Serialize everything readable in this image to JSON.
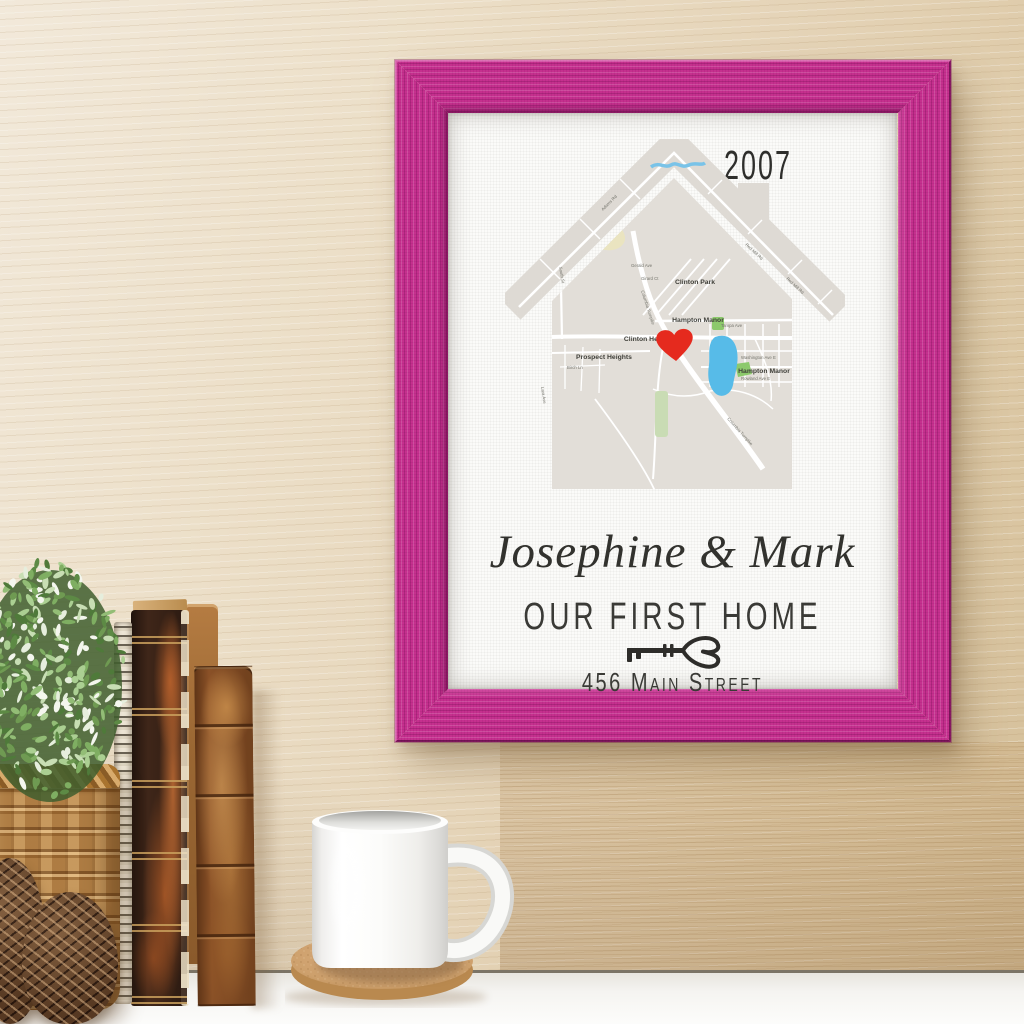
{
  "artwork": {
    "year": "2007",
    "names": "Josephine & Mark",
    "subtitle": "OUR FIRST HOME",
    "address": "456 Main Street",
    "map": {
      "district_labels": [
        "Clinton Park",
        "Hampton Manor",
        "Clinton Heights",
        "Prospect Heights",
        "Hampton Manor"
      ],
      "street_labels": [
        "Columbia Turnpike",
        "Columbia Turnpike",
        "Red Mill Rd",
        "Red Mill Rd",
        "Tampa Ave",
        "Washington Ave E",
        "Rowland Ave E",
        "South St",
        "Gerald Ave",
        "Girard Ct",
        "Adams Rd",
        "Birch Ln",
        "Lara Ave"
      ]
    }
  },
  "colors": {
    "frame-pink": "#c5308e",
    "heart-red": "#e52a1e",
    "pond-blue": "#57bbe8",
    "park-green": "#8cc96c",
    "sage-green": "#c9dcb4",
    "khaki": "#e6dfb4",
    "map-base": "#e2ded8",
    "map-roof": "#dedad4",
    "road-white": "#ffffff",
    "canvas-white": "#fbfbf9",
    "wall-wood": "#e8dac2",
    "shelf-white": "#f3f2ef",
    "text-ink": "#33332f"
  }
}
